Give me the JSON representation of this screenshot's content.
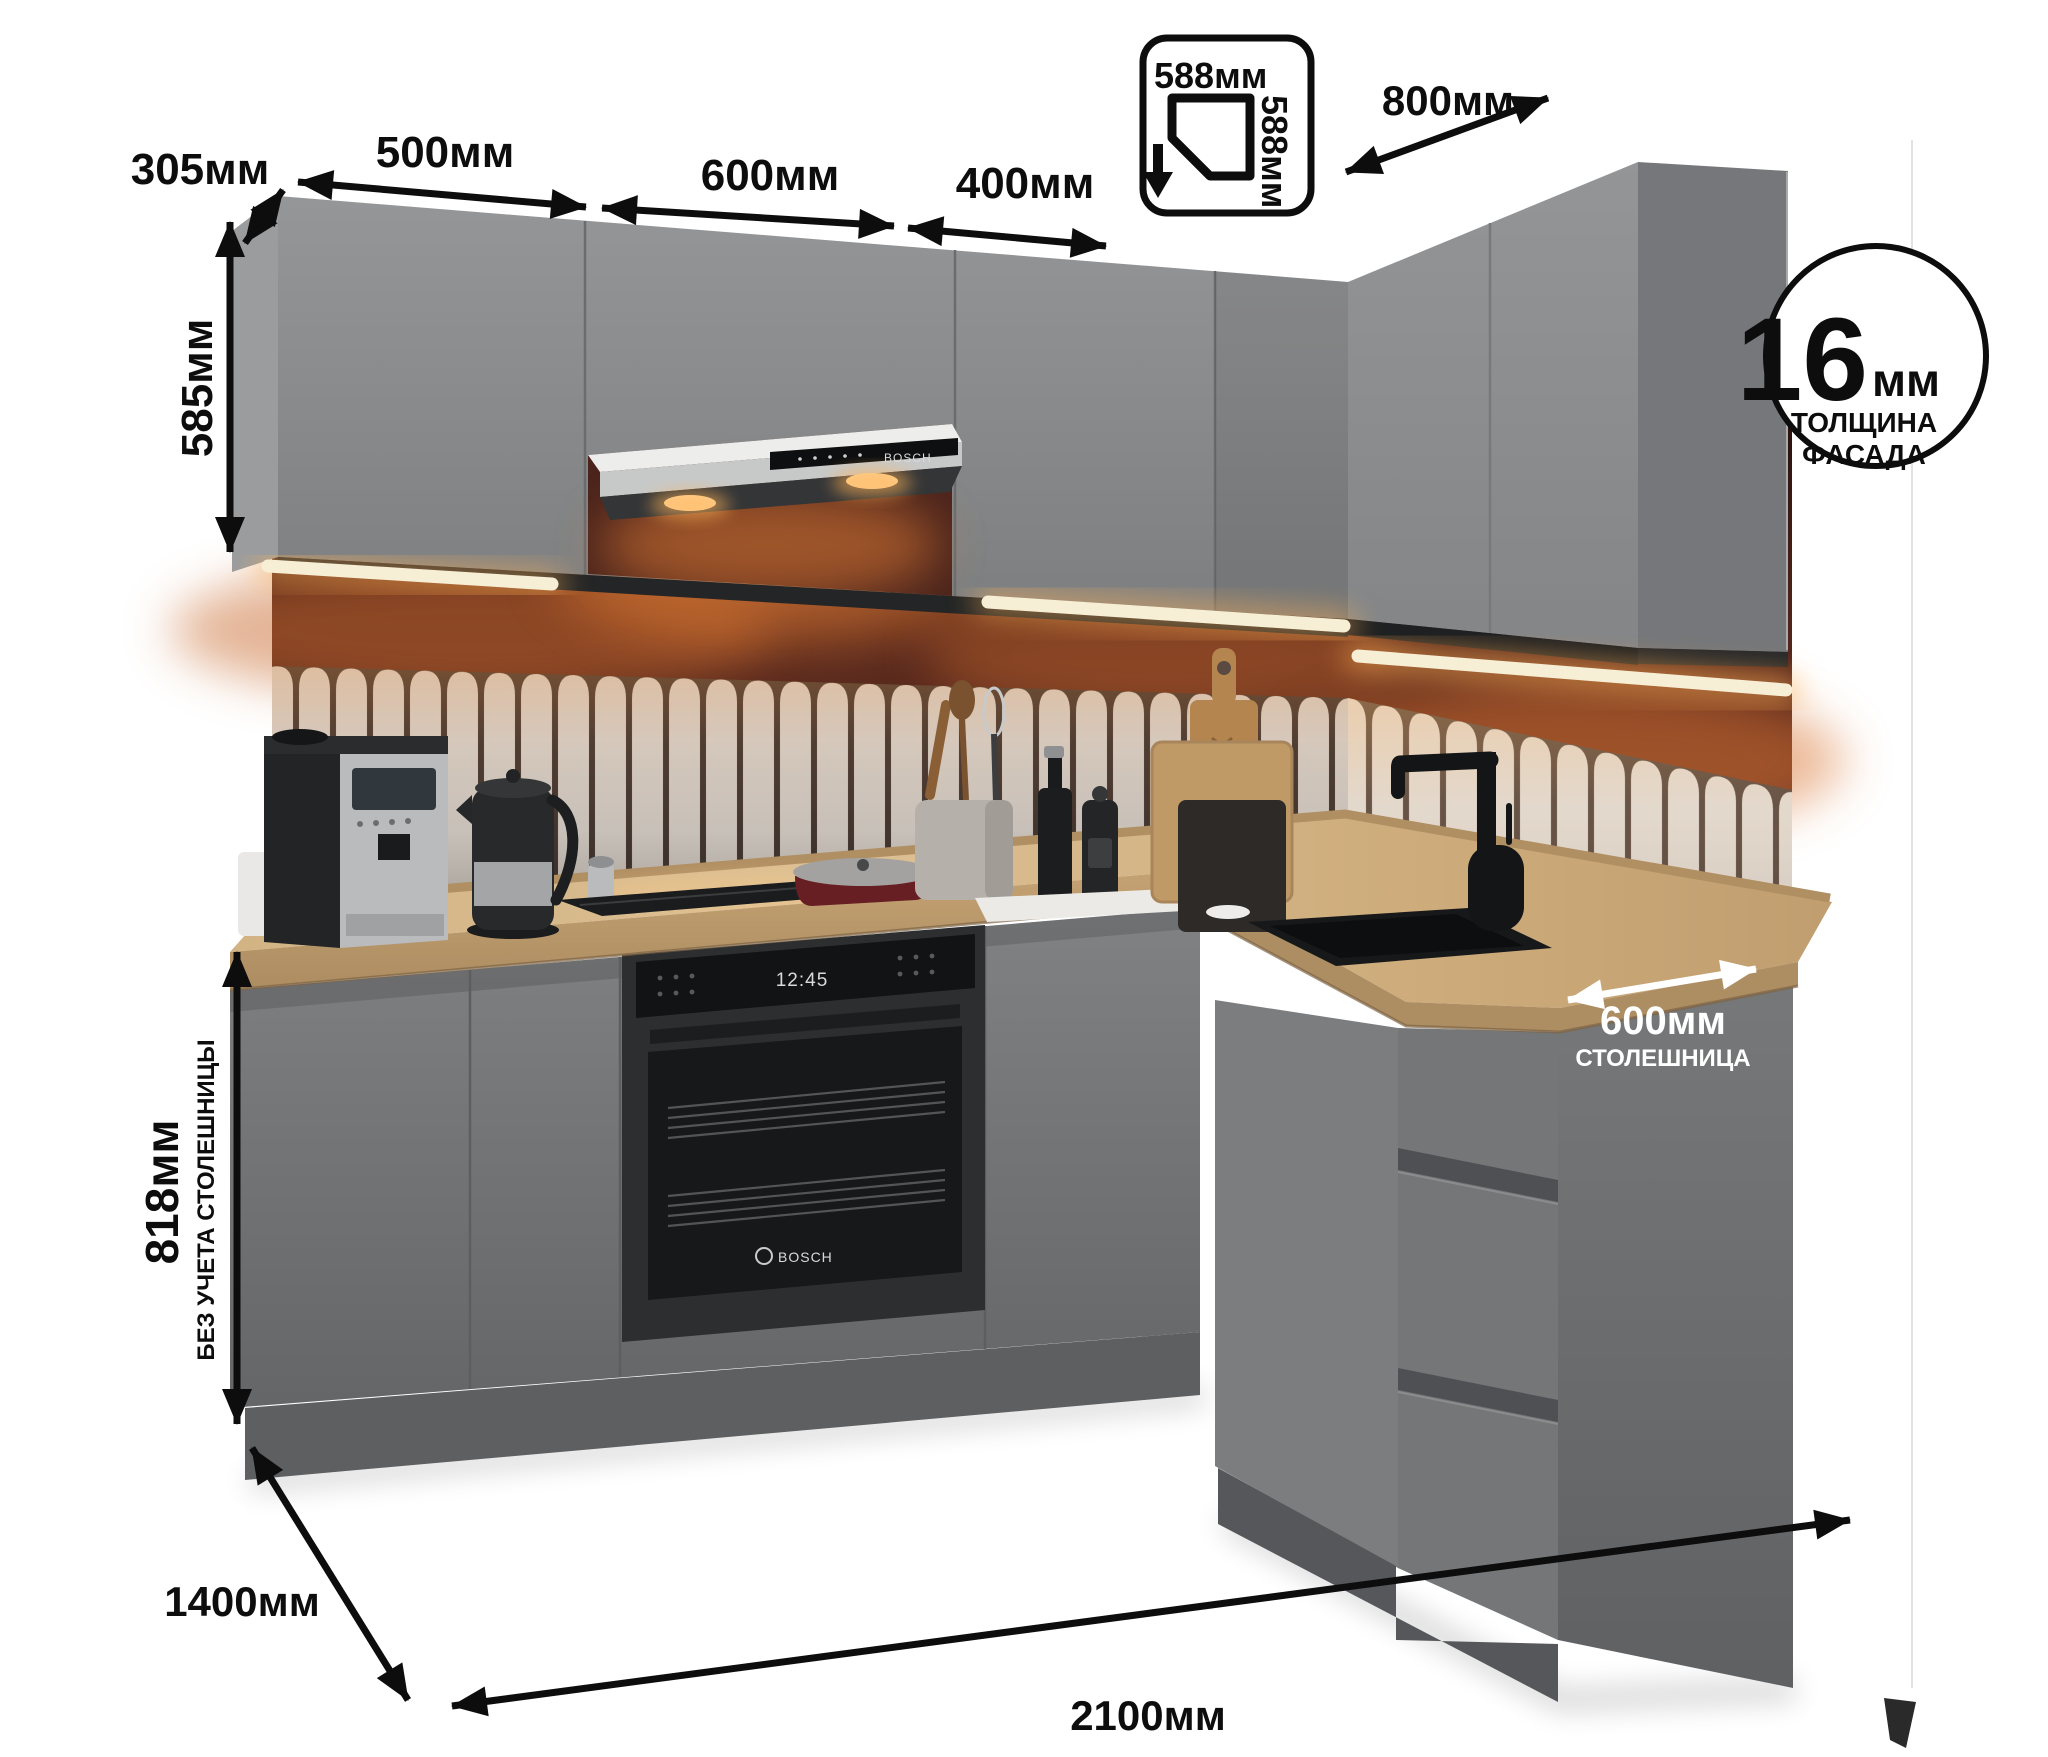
{
  "meta": {
    "subject": "corner-kitchen-product-render"
  },
  "palette": {
    "annotation": "#0d0d0d",
    "annotation_white": "#ffffff",
    "cabinet_gray": "#8d8f91",
    "base_gray": "#77797b",
    "countertop_wood": "#cfae7e",
    "wall_burgundy": "#56281e",
    "tile_cream": "#d3cbc3",
    "led_warm": "#ffcf8e",
    "background": "#ffffff"
  },
  "dimensions": {
    "upper_side_depth": "305мм",
    "upper_section_1": "500мм",
    "upper_section_2": "600мм",
    "upper_section_3": "400мм",
    "upper_right_run": "800мм",
    "corner_cabinet_width": "588мм",
    "corner_cabinet_depth": "588мм",
    "upper_cabinet_height": "585мм",
    "base_cabinet_height": "818мм",
    "base_cabinet_height_note": "БЕЗ УЧЕТА СТОЛЕШНИЦЫ",
    "countertop_depth": "600мм",
    "countertop_depth_note": "СТОЛЕШНИЦА",
    "left_run_length": "1400мм",
    "right_run_length": "2100мм"
  },
  "facade_badge": {
    "value": "16",
    "unit": "мм",
    "caption_line1": "ТОЛЩИНА",
    "caption_line2": "ФАСАДА"
  },
  "appliances": {
    "hood_brand": "BOSCH",
    "oven_brand": "BOSCH",
    "oven_clock": "12:45"
  }
}
